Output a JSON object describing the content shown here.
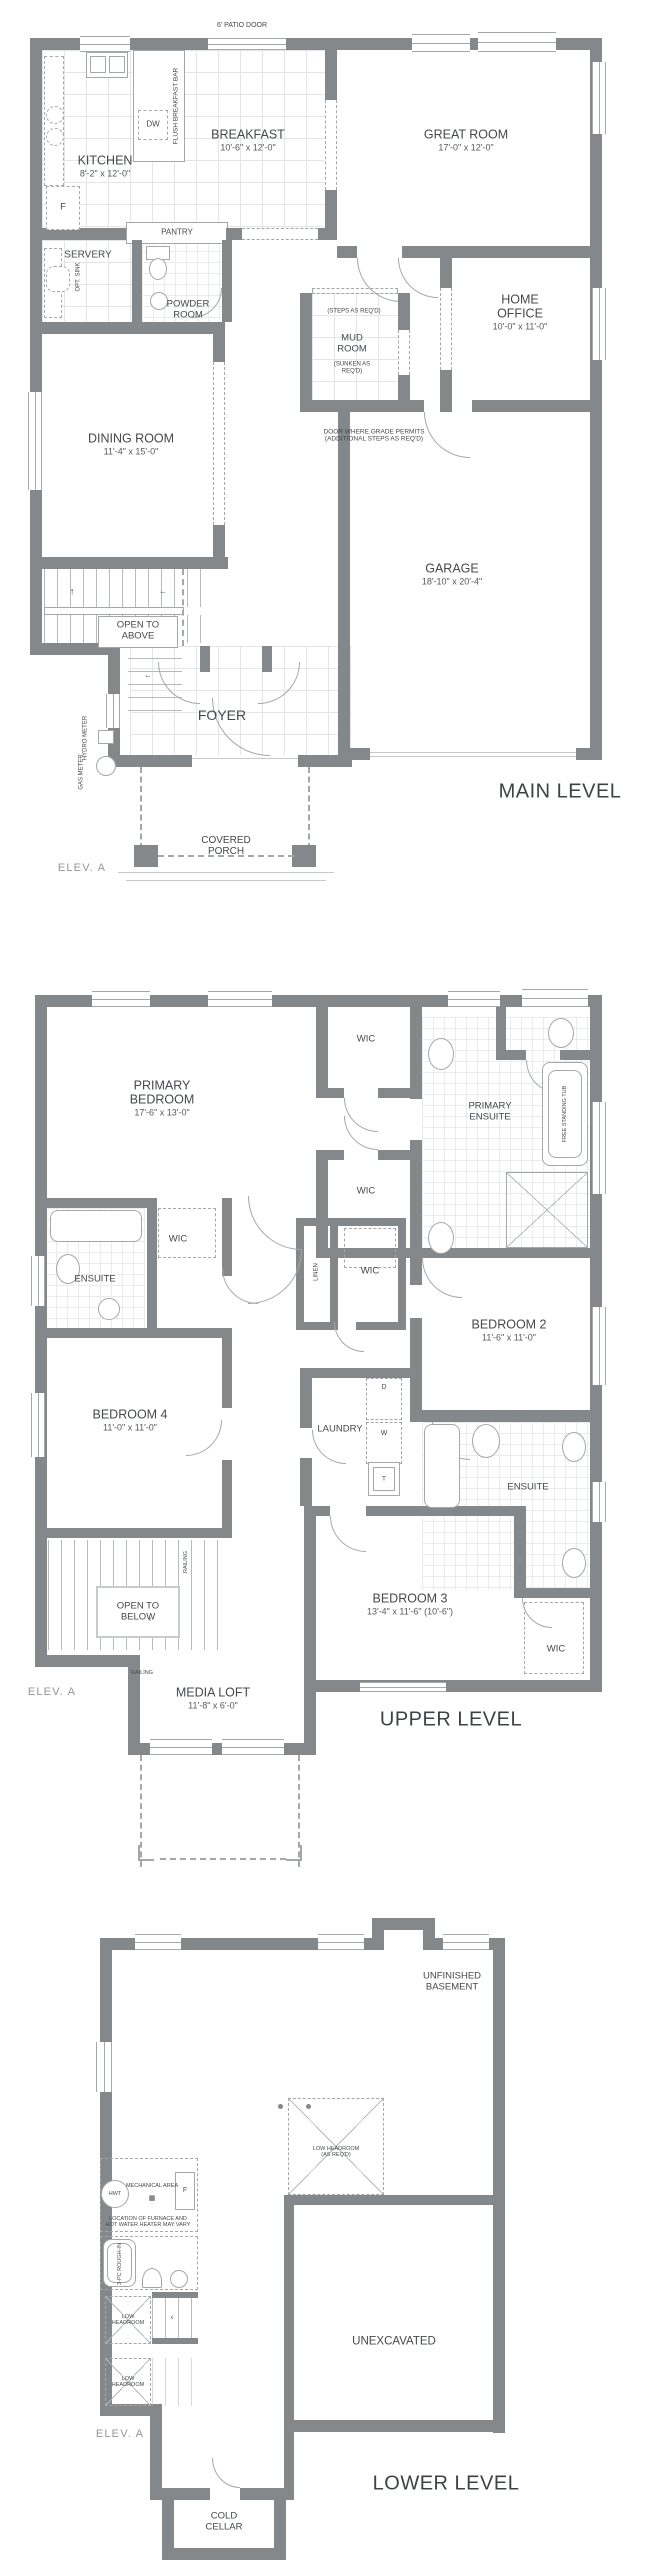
{
  "colors": {
    "wall": "#84888b",
    "line": "#a4a8ab",
    "grid": "#e3e5e6",
    "text": "#45484b",
    "muted": "#939699"
  },
  "icons": {
    "arrow_up": "↑",
    "arrow_left": "←",
    "arrow_small": "‹",
    "furnace": "▦"
  },
  "main": {
    "title": "MAIN LEVEL",
    "elev": "ELEV. A",
    "patio_door": "6' PATIO DOOR",
    "kitchen": {
      "name": "KITCHEN",
      "dim": "8'-2\" x 12'-0\""
    },
    "breakfast": {
      "name": "BREAKFAST",
      "dim": "10'-6\" x 12'-0\""
    },
    "great_room": {
      "name": "GREAT ROOM",
      "dim": "17'-0\" x 12'-0\""
    },
    "flush_bar": "FLUSH BREAKFAST BAR",
    "dw": "DW",
    "fridge": "F",
    "pantry": "PANTRY",
    "servery": "SERVERY",
    "opt_sink": "OPT. SINK",
    "powder": "POWDER ROOM",
    "mud": {
      "name": "MUD ROOM",
      "sub": "(SUNKEN AS REQ'D)",
      "steps": "(STEPS AS REQ'D)"
    },
    "home_office": {
      "name": "HOME OFFICE",
      "dim": "10'-0\" x 11'-0\""
    },
    "dining": {
      "name": "DINING ROOM",
      "dim": "11'-4\" x 15'-0\""
    },
    "door_grade": "DOOR WHERE GRADE PERMITS (ADDITIONAL STEPS AS REQ'D)",
    "garage": {
      "name": "GARAGE",
      "dim": "18'-10\" x 20'-4\""
    },
    "open_above": "OPEN TO ABOVE",
    "foyer": "FOYER",
    "hydro": "HYDRO METER",
    "gas": "GAS METER",
    "porch": "COVERED PORCH"
  },
  "upper": {
    "title": "UPPER LEVEL",
    "elev": "ELEV. A",
    "primary": {
      "name": "PRIMARY BEDROOM",
      "dim": "17'-6\" x 13'-0\""
    },
    "wic": "WIC",
    "linen": "LINEN",
    "ensuite": "ENSUITE",
    "primary_ensuite": "PRIMARY ENSUITE",
    "tub": "FREE STANDING TUB",
    "bedroom2": {
      "name": "BEDROOM 2",
      "dim": "11'-6\" x 11'-0\""
    },
    "bedroom4": {
      "name": "BEDROOM 4",
      "dim": "11'-0\" x 11'-0\""
    },
    "bedroom3": {
      "name": "BEDROOM 3",
      "dim": "13'-4\" x 11'-6\" (10'-6\")"
    },
    "laundry": "LAUNDRY",
    "d": "D",
    "w": "W",
    "t": "T",
    "open_below": "OPEN TO BELOW",
    "railing": "RAILING",
    "media_loft": {
      "name": "MEDIA LOFT",
      "dim": "11'-8\" x 6'-0\""
    }
  },
  "lower": {
    "title": "LOWER LEVEL",
    "elev": "ELEV. A",
    "unfinished": "UNFINISHED BASEMENT",
    "low_head_req": "LOW HEADROOM (AS REQ'D)",
    "mech": "MECHANICAL AREA",
    "hwt": "HWT",
    "f": "F",
    "furnace_note": "LOCATION OF FURNACE AND HOT WATER HEATER MAY VARY",
    "rough_in": "3-PC ROUGH-IN",
    "low_head": "LOW HEADROOM",
    "unexcavated": "UNEXCAVATED",
    "cold_cellar": "COLD CELLAR"
  }
}
